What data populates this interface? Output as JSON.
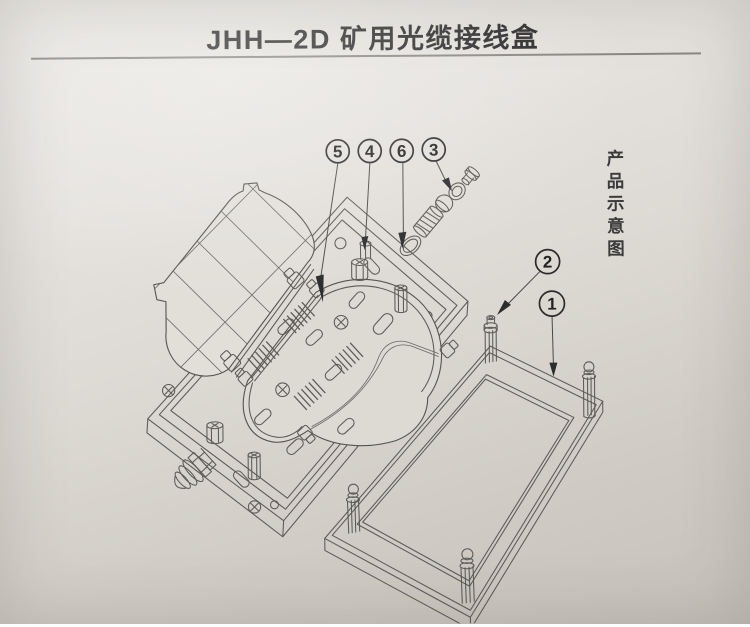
{
  "page": {
    "title": "JHH—2D 矿用光缆接线盒",
    "side_caption": "产品示意图"
  },
  "callouts": [
    {
      "number": "5"
    },
    {
      "number": "4"
    },
    {
      "number": "6"
    },
    {
      "number": "3"
    },
    {
      "number": "2"
    },
    {
      "number": "1"
    }
  ],
  "colors": {
    "paper_light": "#ebe9e5",
    "paper_dark": "#c6c2bb",
    "ink_title": "#2d2d2d",
    "line": "#5c5a56",
    "underline": "#8b8884"
  }
}
